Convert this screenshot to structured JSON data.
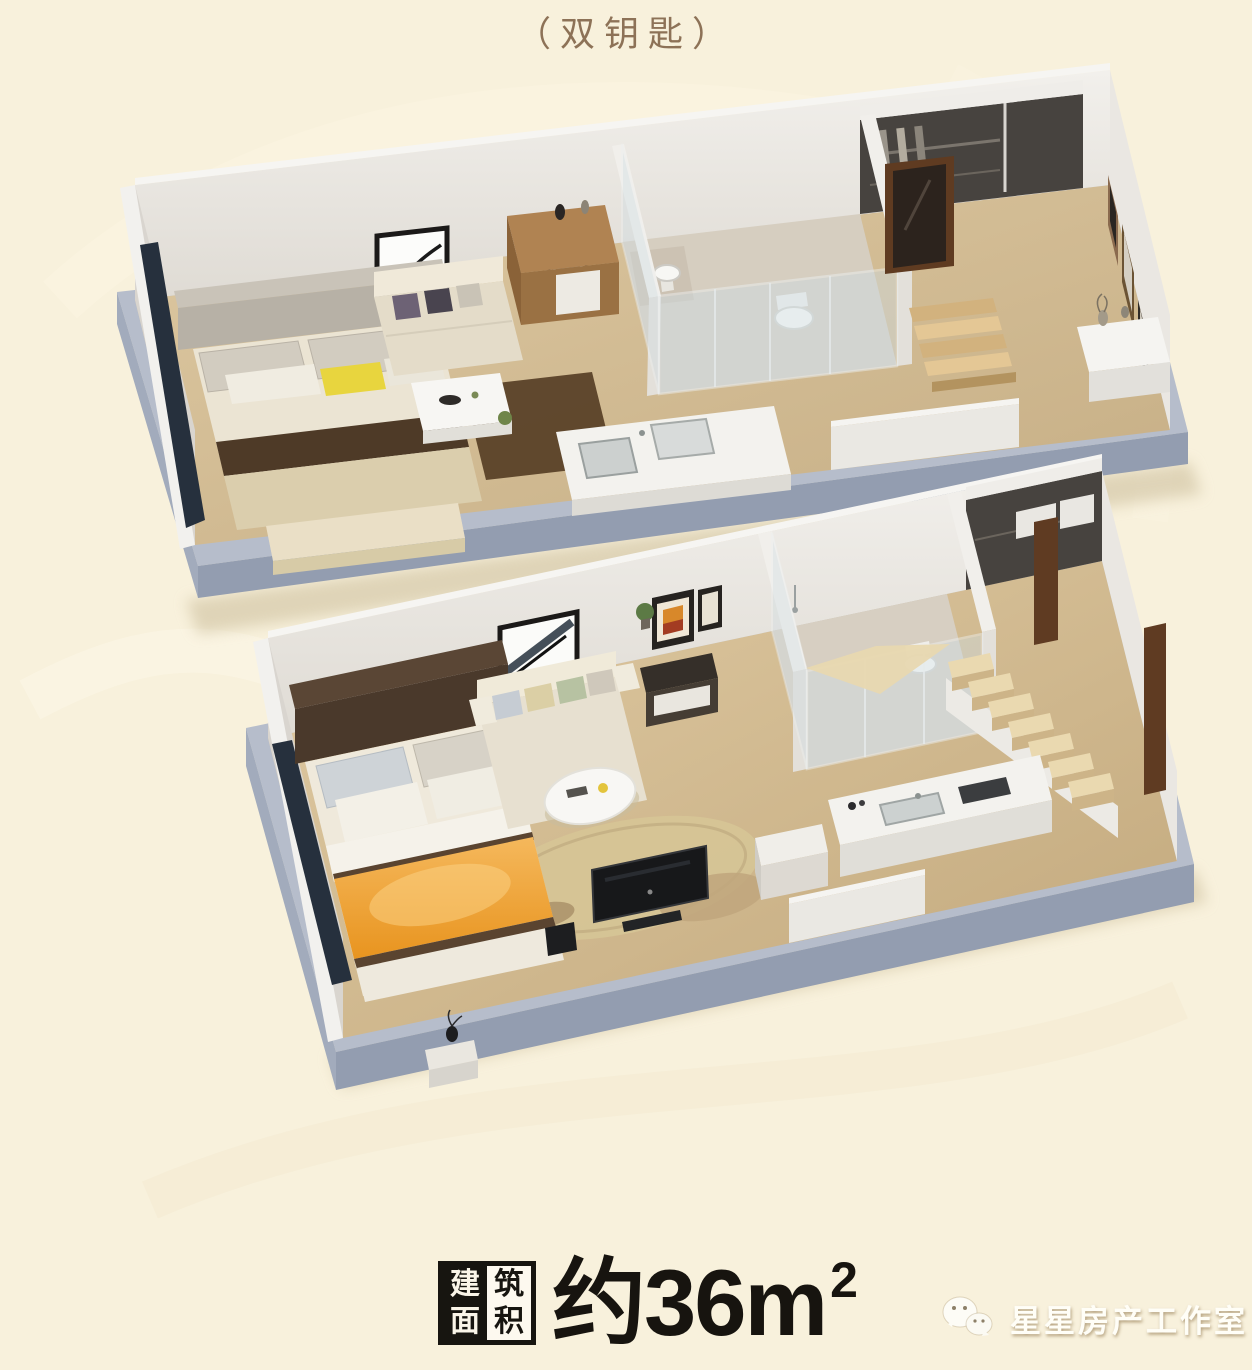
{
  "header": {
    "title": "（双钥匙）"
  },
  "footer": {
    "area_badge": {
      "chars": [
        "建",
        "筑",
        "面",
        "积"
      ]
    },
    "area_text": {
      "value": "约36m",
      "superscript": "2"
    },
    "watermark": {
      "icon": "wechat-bubbles-icon",
      "text": "星星房产工作室"
    }
  },
  "palette": {
    "background": "#f8f1dc",
    "title_color": "#8d7257",
    "plate_top": "#b6bdcb",
    "plate_front": "#939db0",
    "wall_white": "#edebe7",
    "wood_floor": "#d5bf98",
    "accent_yellow_pillow": "#e8d53e",
    "accent_orange_blanket": "#f0a93e",
    "badge_black": "#171510",
    "watermark_white": "#fffef7"
  },
  "floor_plans": {
    "upper": {
      "label": "upper-floor-3d-plan",
      "features": [
        "bedroom",
        "sofa-lounge",
        "kitchenette",
        "glass-bathroom",
        "steps",
        "entry-gallery",
        "wardrobe"
      ]
    },
    "lower": {
      "label": "lower-floor-3d-plan",
      "features": [
        "bedroom",
        "sofa-lounge",
        "round-table",
        "tv",
        "glass-bathroom",
        "staircase",
        "kitchen",
        "wardrobe"
      ]
    }
  }
}
